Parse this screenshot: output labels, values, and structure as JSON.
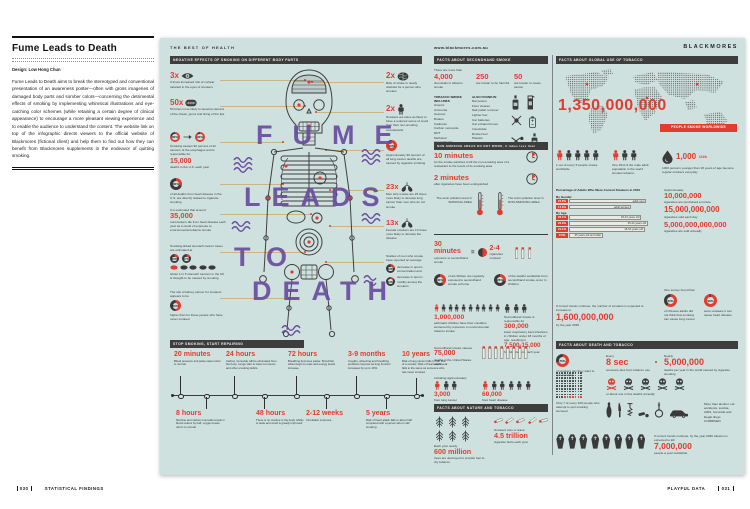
{
  "colors": {
    "poster_bg": "#cfe1de",
    "accent_red": "#e23b30",
    "purple": "#684ca0",
    "bar_dark": "#3d3d3d",
    "connector_tan": "#c9b482"
  },
  "footer": {
    "left_page": "030",
    "left_label": "STATISTICAL FINDINGS",
    "right_label": "PLAYFUL DATA",
    "right_page": "031"
  },
  "sidebar": {
    "title": "Fume Leads to Death",
    "credit": "Design: Low Hong Chun",
    "body": "Fume Leads to Death aims to break the stereotyped and conventional presentation of an awareness poster—often with gross imageries of damaged body parts and somber colors—concerning the detrimental effects of smoking by implementing whimsical illustrations and eye-catching color schemes (while retaining a certain degree of clinical appearance) to encourage a more pleasant viewing experience and to enable the audience to understand the content. The website link on top of the infographic directs viewers to the official website of Blackmores (fictional client) and help them to find out how they can benefit from Blackmores supplements in the endeavor of quitting smoking."
  },
  "poster": {
    "left": {
      "kicker": "THE BEST OF HEALTH",
      "section_title": "NEGATIVE EFFECTS OF SMOKING ON DIFFERENT BODY PARTS",
      "figure_words": [
        "FUME",
        "LEADS",
        "TO",
        "DEATH"
      ],
      "stats_left": [
        {
          "value": "3x",
          "caption": "3 times increased risk of nuclear cataract in the eyes of smokers"
        },
        {
          "value": "50x",
          "caption": "50 times more likely to develop cancers of the cheek, gums and lining of the lips"
        },
        {
          "pct_a": "80%",
          "pct_b": "90%",
          "lead": "Smoking causes 90 percent of all cancers of the esophagus and is responsible for",
          "value": "15,000",
          "caption": "deaths in the U.S. each year"
        },
        {
          "pct": "30%",
          "caption": "of all deaths from heart disease in the U.S. are directly related to cigarette smoking"
        },
        {
          "lead": "It is estimated that around",
          "value": "35,000",
          "caption": "nonsmokers die from heart disease each year as a result of exposure to environmental tobacco smoke"
        },
        {
          "lead": "Smoking-linked stomach cancer cases are estimated at",
          "pct_a": "20%",
          "pct_b": "17%",
          "caption": "About 1 in 5 stomach cancers in the UK is thought to be caused by smoking"
        },
        {
          "lead": "The risk of kidney cancer for smokers appears to be",
          "pct": "50%",
          "caption": "higher than for those people who have never smoked"
        }
      ],
      "stats_right": [
        {
          "value": "2x",
          "caption": "Risk of stroke is nearly doubled for a person who smokes"
        },
        {
          "value": "2x",
          "caption": "Smokers are twice as likely to have a reduced sense of smell than their non-smoking counterparts"
        },
        {
          "pct": "90%",
          "caption": "Approximately 90 percent of all lung cancer deaths are caused by cigarette smoking"
        },
        {
          "value": "23x",
          "caption": "Men who smoke are 23 times more likely to develop lung cancer than men who do not smoke"
        },
        {
          "value": "13x",
          "caption": "Female smokers are 13 times more likely to develop the disease"
        },
        {
          "lead": "Studies of men who smoke have reported an average",
          "pct_a": "23%",
          "cap_a": "decrease in sperm concentration and",
          "pct_b": "13%",
          "cap_b": "decrease in sperm motility among the smokers"
        }
      ],
      "timeline": {
        "title": "STOP SMOKING, START REPAIRING",
        "items": [
          {
            "label": "20 minutes",
            "caption": "Blood pressure and pulse rates return to normal."
          },
          {
            "label": "8 hours",
            "caption": "Nicotine and carbon monoxide levels in blood reduce by half, oxygen levels return to normal."
          },
          {
            "label": "24 hours",
            "caption": "Carbon monoxide will be eliminated from the body. Lungs start to clear out mucus and other smoking debris."
          },
          {
            "label": "48 hours",
            "caption": "There is no nicotine in the body. Ability to taste and smell is greatly improved."
          },
          {
            "label": "72 hours",
            "caption": "Breathing becomes easier. Bronchial tubes begin to relax and energy levels increase."
          },
          {
            "label": "2-12 weeks",
            "caption": "Circulation improves."
          },
          {
            "label": "3-9 months",
            "caption": "Coughs, wheezing and breathing problems improve as lung function increases by up to 10%."
          },
          {
            "label": "5 years",
            "caption": "Risk of heart attack falls to about half compared with a person who is still smoking."
          },
          {
            "label": "10 years",
            "caption": "Risk of lung cancer falls to half that of a smoker. Risk of heart attack falls to the same as someone who has never smoked."
          }
        ]
      }
    },
    "middle": {
      "url": "www.blackmores.com.au",
      "section1_title": "FACTS ABOUT SECONDHAND SMOKE",
      "chem": {
        "lead": "There are more than",
        "stats": [
          {
            "value": "4,000",
            "caption": "chemicals in tobacco smoke"
          },
          {
            "value": "250",
            "caption": "are known to be harmful"
          },
          {
            "value": "50",
            "caption": "are known to cause cancer"
          }
        ],
        "list1_title": "TOBACCO SMOKE INCLUDES",
        "list1": [
          "Arsenic",
          "Ammonia",
          "Acetone",
          "Butane",
          "Cadmium",
          "Carbon monoxide",
          "DDT",
          "Methanol",
          "Vinyl Chloride"
        ],
        "list2_title": "ALSO FOUND IN",
        "list2": [
          "Rat poison",
          "Floor cleaner",
          "Nail polish remover",
          "Lighter fuel",
          "Car batteries",
          "Car exhaust fumes",
          "Insecticide",
          "Rocket fuel",
          "Plastics"
        ]
      },
      "nosmoke": {
        "bar": "NON-SMOKING AREAS DO NOT WORK, it takes less than",
        "t1": "10 minutes",
        "t1_caption": "for the smoke particles to fill the non-smoking area of a restaurant to the levels of its smoking area",
        "t2": "2 minutes",
        "t2_caption": "after cigarettes have been extinguished",
        "thermo1": "The toxin pollution level in SMOKING AREA",
        "thermo2": "The toxin pollution level in NON-SMOKING AREA"
      },
      "thirty": {
        "value": "30 minutes",
        "caption": "exposure to secondhand smoke",
        "equals": "=",
        "result": "2-4",
        "result_caption": "cigarettes smoked"
      },
      "children": {
        "c1_pct": "40%",
        "c1_caption": "of all children are regularly exposed to secondhand smoke at home",
        "c2_pct": "28%",
        "c2_caption": "of the deaths worldwide from secondhand smoke occur in children",
        "asthma_value": "1,000,000",
        "asthma_caption": "asthmatic children have their condition worsened by exposure to environmental tobacco smoke",
        "resp_lead": "Secondhand smoke is responsible for",
        "resp_value": "300,000",
        "resp_caption": "lower respiratory tract infections in children under 18 months of age, resulting in",
        "hosp_value": "7,500-15,000",
        "hosp_caption": "hospitalizations each year"
      },
      "deaths": {
        "lead": "Secondhand smoke causes",
        "value": "75,000",
        "caption": "deaths in the United States each year",
        "incl": "Including approximately",
        "lung_value": "3,000",
        "lung_caption": "from lung cancer",
        "heart_value": "60,000",
        "heart_caption": "from heart disease"
      },
      "section2_title": "FACTS ABOUT NATURE AND TOBACCO",
      "nature": {
        "trees_lead": "Each year nearly",
        "trees_value": "600 million",
        "trees_caption": "trees are destroyed to provide fuel to dry tobacco",
        "butts_lead": "Smokers toss or leave",
        "butts_value": "4.5 trillion",
        "butts_caption": "cigarette butts each year"
      }
    },
    "right": {
      "logo": "BLACKMORES",
      "section1_title": "FACTS ABOUT GLOBAL USE OF TOBACCO",
      "global": {
        "big_value": "1,350,000,000",
        "badge": "PEOPLE SMOKE WORLDWIDE",
        "p1": "1 out of every 5 people smoke worldwide",
        "p2": "One third of the male adult population in the world smokes tobacco",
        "teen_value": "1,000",
        "teen_unit": "/24h",
        "teen_caption": "1000 persons younger than 18 years of age become regular smokers everyday"
      },
      "chart": {
        "title": "Percentage of Adults Who Were Current Smokers in 2010",
        "group1": "By Gender",
        "group2": "By Age",
        "bars": [
          {
            "pct": "21.5%",
            "label": "adult men"
          },
          {
            "pct": "17.3%",
            "label": "adult women"
          },
          {
            "pct": "20.1%",
            "label": "18-24 years old"
          },
          {
            "pct": "22.0%",
            "label": "25-44 years old"
          },
          {
            "pct": "21.1%",
            "label": "45-64 years old"
          },
          {
            "pct": "9.5%",
            "label": "65 years old and older"
          }
        ]
      },
      "cigs": {
        "lead": "Approximately",
        "v1": "10,000,000",
        "c1": "cigarettes are purchased a minute",
        "v2": "15,000,000,000",
        "c2": "cigarettes sold each day",
        "v3": "5,000,000,000,000",
        "c3": "cigarettes are sold annually"
      },
      "survey": {
        "lead": "One survey found that",
        "s1_pct": "60%",
        "s1_caption": "of Chinese adults did not think that smoking can cause lung cancer",
        "s2_pct": "96%",
        "s2_caption": "were unaware it can cause heart disease"
      },
      "trend": {
        "lead": "If current trends continue, the number of smokers is expected to increase to",
        "value": "1,600,000,000",
        "caption": "by the year 2025"
      },
      "section2_title": "FACTS ABOUT DEATH AND TOBACCO",
      "death": {
        "quit_pct": "70%",
        "quit_caption": "of smokers say they want to quit smoking",
        "every": "Every",
        "sec_value": "8 sec",
        "sec_caption": "someone dies from tobacco use",
        "nearly": "Nearly",
        "yr_value": "5,000,000",
        "yr_caption": "deaths per year in the world caused by cigarette smoking",
        "skull_caption": "or about one in five deaths annually",
        "grid_caption": "Only 7 of every 100 people who attempt to quit smoking succeed",
        "grid_total": 100,
        "grid_red": 7,
        "weapons_caption": "More than alcohol, car accidents, suicide, AIDS, homicide and illegal drugs COMBINED",
        "coffin_lead": "If current trends continue, by the year 2030 tobacco is expected to kill",
        "coffin_value": "7,000,000",
        "coffin_caption": "people a year worldwide"
      }
    }
  },
  "chart_data": {
    "type": "bar",
    "title": "Percentage of Adults Who Were Current Smokers in 2010",
    "unit": "%",
    "xlim": [
      0,
      25
    ],
    "groups": [
      {
        "name": "By Gender",
        "categories": [
          "adult men",
          "adult women"
        ],
        "values": [
          21.5,
          17.3
        ]
      },
      {
        "name": "By Age",
        "categories": [
          "18-24 years old",
          "25-44 years old",
          "45-64 years old",
          "65 years old and older"
        ],
        "values": [
          20.1,
          22.0,
          21.1,
          9.5
        ]
      }
    ]
  }
}
